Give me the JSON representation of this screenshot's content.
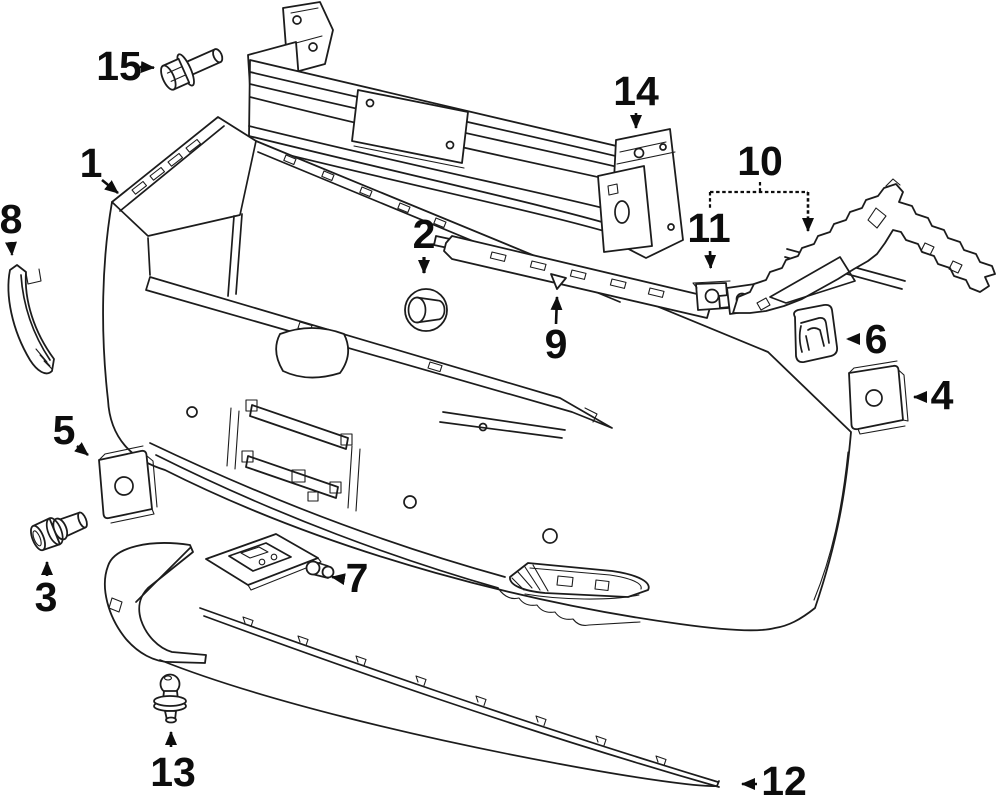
{
  "diagram": {
    "background": "#ffffff",
    "line_color": "#1c1c1c",
    "label_color": "#0d0d0d"
  },
  "callouts": {
    "c1": {
      "label": "1"
    },
    "c2": {
      "label": "2"
    },
    "c3": {
      "label": "3"
    },
    "c4": {
      "label": "4"
    },
    "c5": {
      "label": "5"
    },
    "c6": {
      "label": "6"
    },
    "c7": {
      "label": "7"
    },
    "c8": {
      "label": "8"
    },
    "c9": {
      "label": "9"
    },
    "c10": {
      "label": "10"
    },
    "c11": {
      "label": "11"
    },
    "c12": {
      "label": "12"
    },
    "c13": {
      "label": "13"
    },
    "c14": {
      "label": "14"
    },
    "c15": {
      "label": "15"
    }
  }
}
